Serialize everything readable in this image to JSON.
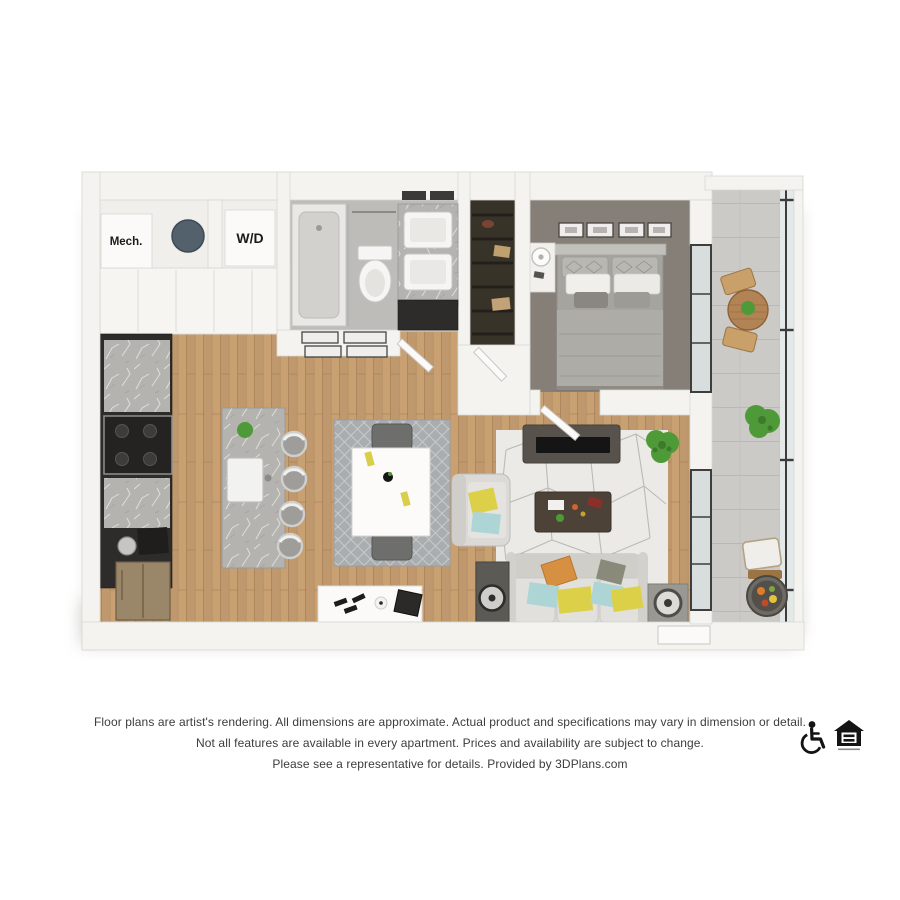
{
  "floor_plan": {
    "labels": {
      "mech": "Mech.",
      "washer_dryer": "W/D"
    }
  },
  "disclaimer": {
    "line1": "Floor plans are artist's rendering. All dimensions are approximate. Actual product and specifications may vary in dimension or detail.",
    "line2": "Not all features are available in every apartment. Prices and availability are subject to change.",
    "line3": "Please see a representative for details. Provided by 3DPlans.com"
  },
  "footer_icons": {
    "accessibility": "wheelchair-icon",
    "equal_housing": "equal-housing-opportunity-icon"
  },
  "colors": {
    "background": "#ffffff",
    "wall": "#f4f3f0",
    "wall_edge": "#d8d6d2",
    "wood_floor": "#c8a072",
    "carpet": "#867f77",
    "tile": "#bdbcb9",
    "cabinet_dark": "#2e2c2a",
    "marble": "#b4b3b0",
    "sofa": "#d9d8d4",
    "pillow_yellow": "#ddd049",
    "pillow_blue": "#aed5d6",
    "pillow_orange": "#d79041",
    "plant_green": "#4f9a38",
    "glass": "#d8dedd",
    "text": "#3c3c3c"
  }
}
